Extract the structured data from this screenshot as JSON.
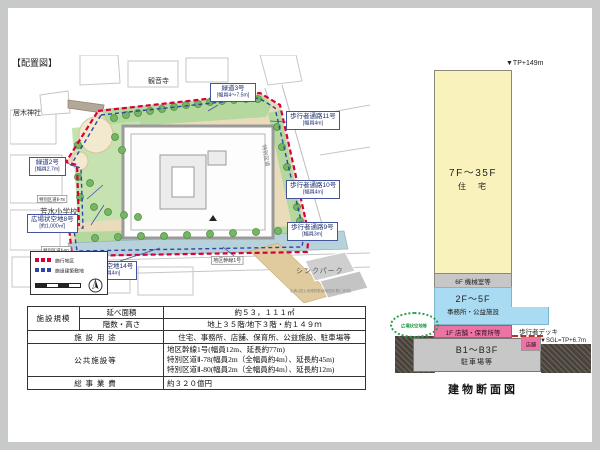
{
  "plan": {
    "title": "【配置図】"
  },
  "map": {
    "kannonji": "観音寺",
    "irugi_shrine": "居木神社",
    "hosui_school": "芳水小学校",
    "think_park": "シンクパーク",
    "greenway3_name": "緑道3号",
    "greenway3_spec": "[幅員4～7.5m]",
    "walkway11_name": "歩行者通路11号",
    "walkway11_spec": "[幅員4m]",
    "walkway10_name": "歩行者通路10号",
    "walkway10_spec": "[幅員4m]",
    "walkway9_name": "歩行者通路9号",
    "walkway9_spec": "[幅員3m]",
    "greenway2_name": "緑道2号",
    "greenway2_spec": "[幅員2.7m]",
    "plaza8_name": "広場状空地8号",
    "plaza8_spec": "[約1,000㎡]",
    "walkpath14_name": "歩道状空地14号",
    "walkpath14_spec": "[幅員4m]",
    "ward_road78": "特別区道Ⅱ-78",
    "ward_road80": "特別区道Ⅱ-80",
    "district_trunk1": "地区幹線1号",
    "ward_road_vertical": "特別区道",
    "legend_district": "施行地区",
    "legend_site": "施設建築敷地",
    "source_note": "出典:(国土地理院数値地図を基に作成)"
  },
  "table": {
    "scale_group": "施設規模",
    "floor_area_label": "延べ面積",
    "floor_area_value": "約５３，１１１㎡",
    "floors_label": "階数・高さ",
    "floors_value": "地上３５階/地下３階・約１４９ｍ",
    "use_label": "施 設 用 途",
    "use_value": "住宅、事務所、店舗、保育所、公益施設、駐車場等",
    "public_label": "公共施設等",
    "public_line1": "地区幹線1号(幅員12m、延長約77m)",
    "public_line2": "特別区道Ⅱ-78(幅員2m（全幅員約4m）、延長約45m)",
    "public_line3": "特別区道Ⅱ-80(幅員2m（全幅員約4m）、延長約12m)",
    "cost_label": "総 事 業 費",
    "cost_value": "約３２０億円"
  },
  "section": {
    "tp_top": "▼TP+149m",
    "tower_floors": "7F～35F",
    "tower_use": "住　宅",
    "band6f": "6F 機械室等",
    "mid_floors": "2F～5F",
    "mid_use": "事務所・公益施設",
    "f1": "1F 店舗・保育所等",
    "deck": "歩行者デッキ",
    "shop": "店舗",
    "sgl": "▼SGL=TP+6.7m",
    "basement_floors": "B1～B3F",
    "basement_use": "駐車場等",
    "plaza": "広場状空地等",
    "caption": "建物断面図"
  },
  "colors": {
    "district_boundary": "#d6003c",
    "site_boundary": "#2b46a8",
    "tower_residential": "#f9f2bc",
    "office_public": "#a9dcf2",
    "retail_pink": "#ec74a4",
    "machine_gray": "#c7c7c7",
    "plaza_green": "#2a9d4a"
  }
}
